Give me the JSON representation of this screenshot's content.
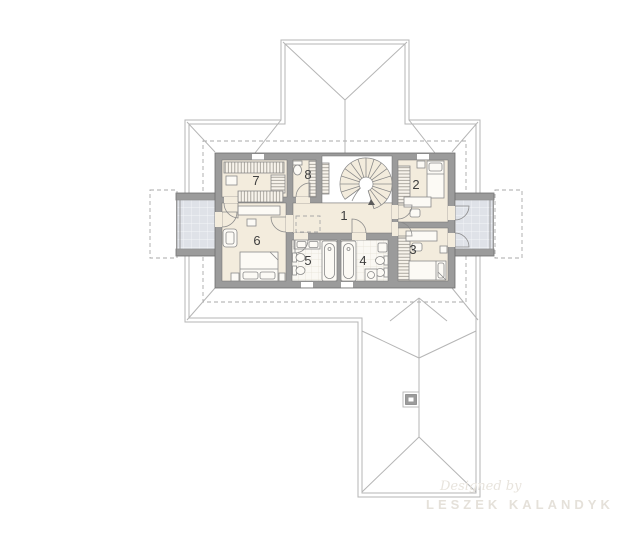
{
  "plan": {
    "rooms": [
      {
        "number": "1"
      },
      {
        "number": "2"
      },
      {
        "number": "3"
      },
      {
        "number": "4"
      },
      {
        "number": "5"
      },
      {
        "number": "6"
      },
      {
        "number": "7"
      },
      {
        "number": "8"
      }
    ],
    "watermark": {
      "script_line": "Designed by",
      "name_line": "LESZEK KALANDYK"
    }
  },
  "colors": {
    "page_bg": "#ffffff",
    "roof_line": "#b5b5b5",
    "dash": "#a8a8a8",
    "wall": "#9b9b9b",
    "wall_edge": "#6f6f6f",
    "floor": "#f3ecdd",
    "tile": "#faf8f3",
    "tile_grid": "#e7e2d7",
    "balcony": "#dfe2e8",
    "balcony_grid": "#f3f5f8",
    "furn": "#8a8a8a",
    "furn_fill": "#fcfaf5",
    "label": "#3f3f3f",
    "watermark1": "#e8e4dd",
    "watermark2": "#e5e1da"
  }
}
